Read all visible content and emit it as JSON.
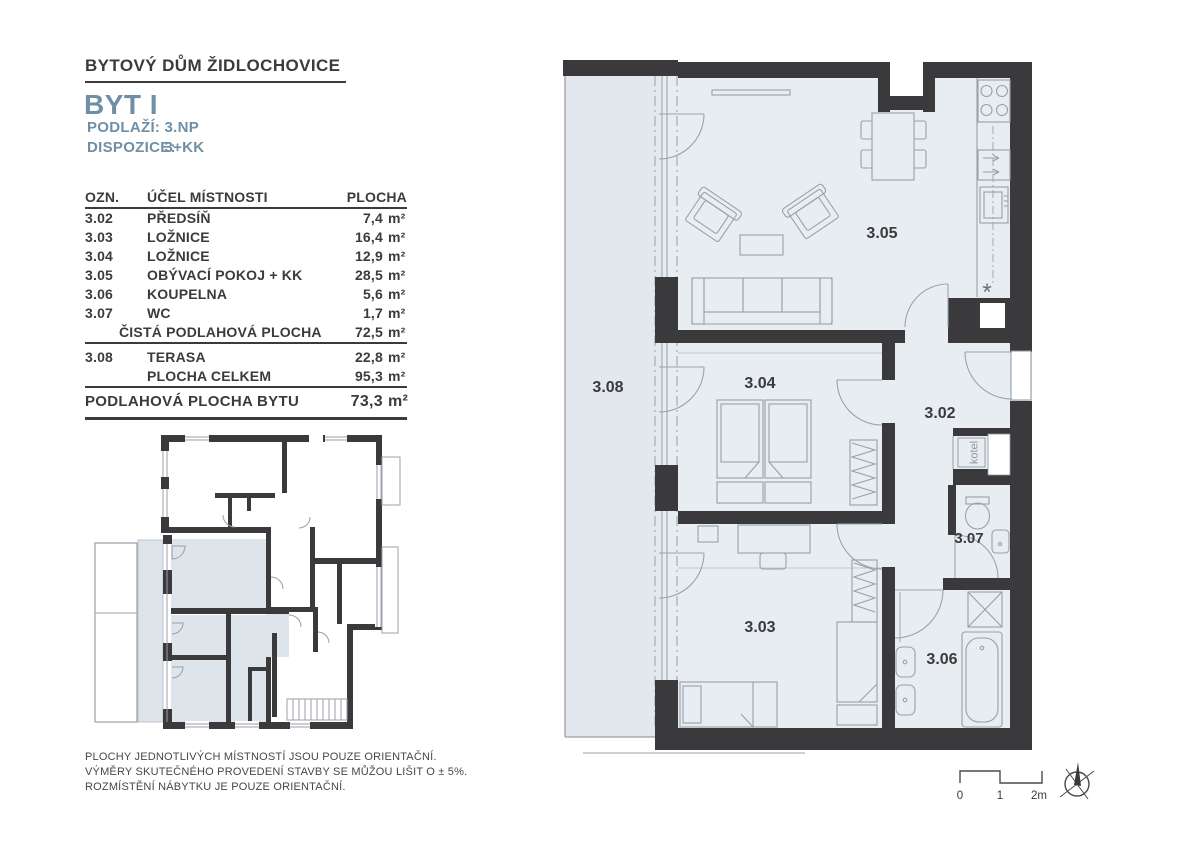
{
  "document": {
    "project_title": "BYTOVÝ DŮM ŽIDLOCHOVICE",
    "unit_title": "BYT I",
    "floor_label": "PODLAŽÍ:",
    "floor_value": "3.NP",
    "layout_label": "DISPOZICE:",
    "layout_value": "3+KK"
  },
  "area_table": {
    "headers": {
      "id": "OZN.",
      "name": "ÚČEL MÍSTNOSTI",
      "area": "PLOCHA"
    },
    "unit": "m²",
    "rows": [
      {
        "id": "3.02",
        "name": "PŘEDSÍŇ",
        "area": "7,4"
      },
      {
        "id": "3.03",
        "name": "LOŽNICE",
        "area": "16,4"
      },
      {
        "id": "3.04",
        "name": "LOŽNICE",
        "area": "12,9"
      },
      {
        "id": "3.05",
        "name": "OBÝVACÍ POKOJ + KK",
        "area": "28,5"
      },
      {
        "id": "3.06",
        "name": "KOUPELNA",
        "area": "5,6"
      },
      {
        "id": "3.07",
        "name": "WC",
        "area": "1,7"
      }
    ],
    "net_row": {
      "label": "ČISTÁ PODLAHOVÁ PLOCHA",
      "area": "72,5"
    },
    "terrace_row": {
      "id": "3.08",
      "name": "TERASA",
      "area": "22,8"
    },
    "total_row": {
      "label": "PLOCHA CELKEM",
      "area": "95,3"
    },
    "summary": {
      "label": "PODLAHOVÁ PLOCHA BYTU",
      "area": "73,3"
    }
  },
  "floor_plan": {
    "labels": {
      "hall": "3.02",
      "bedroom2": "3.03",
      "bedroom1": "3.04",
      "living": "3.05",
      "bathroom": "3.06",
      "wc": "3.07",
      "terrace": "3.08",
      "boiler": "kotel"
    }
  },
  "disclaimer": {
    "lines": [
      "PLOCHY JEDNOTLIVÝCH MÍSTNOSTÍ JSOU POUZE ORIENTAČNÍ.",
      "VÝMĚRY SKUTEČNÉHO PROVEDENÍ STAVBY SE MŮŽOU LIŠIT O ± 5%.",
      "ROZMÍSTĚNÍ NÁBYTKU JE POUZE ORIENTAČNÍ."
    ]
  },
  "scale_bar": {
    "ticks": [
      "0",
      "1",
      "2m"
    ]
  },
  "colors": {
    "accent": "#6f8fa5",
    "wall": "#3a3a3c",
    "room_fill": "#e8edf2",
    "terrace_fill": "#e3e8ee",
    "highlight_fill": "#dde4ea",
    "furniture_line": "#98a0a9",
    "text_dark": "#3b3b3d"
  }
}
